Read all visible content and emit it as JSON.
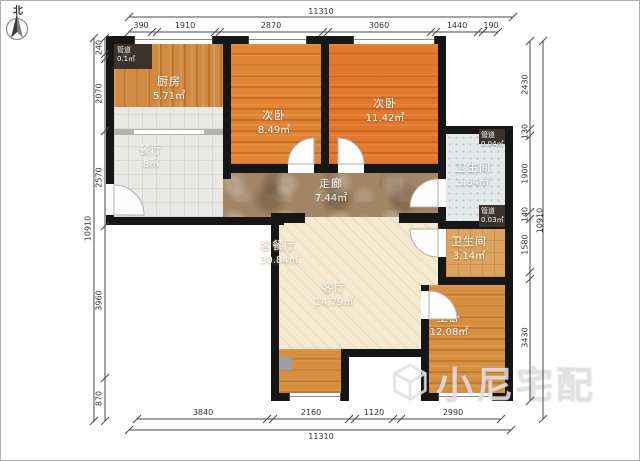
{
  "north_label": "北",
  "watermark": "小尼宅配",
  "dimensions": {
    "top": {
      "total": "11310",
      "segments": [
        "390",
        "1910",
        "2870",
        "3060",
        "1440",
        "190"
      ]
    },
    "bottom": {
      "total": "11310",
      "segments": [
        "3840",
        "2160",
        "1120",
        "2990"
      ]
    },
    "left": {
      "total": "10910",
      "segments": [
        "240",
        "2070",
        "2570",
        "3960",
        "870"
      ]
    },
    "right": {
      "total": "10910",
      "segments": [
        "2430",
        "130",
        "1900",
        "140",
        "1580",
        "3430"
      ]
    }
  },
  "rooms": {
    "kitchen": {
      "label": "厨房",
      "area": "5.71㎡"
    },
    "bedroom_a": {
      "label": "次卧",
      "area": "8.49㎡"
    },
    "bedroom_b": {
      "label": "次卧",
      "area": "11.42㎡"
    },
    "dining": {
      "label": "餐厅",
      "area": "8㎡"
    },
    "corridor": {
      "label": "走廊",
      "area": "7.44㎡"
    },
    "bath_a": {
      "label": "卫生间",
      "area": "3.84㎡"
    },
    "bath_b": {
      "label": "卫生间",
      "area": "3.14㎡"
    },
    "living_dining": {
      "label": "客餐厅",
      "area": "30.84㎡"
    },
    "living": {
      "label": "客厅",
      "area": "14.79㎡"
    },
    "master": {
      "label": "主卧",
      "area": "12.08㎡"
    },
    "duct_kitchen": {
      "label": "管道",
      "area": "0.1㎡"
    },
    "duct_a": {
      "label": "管道",
      "area": "0.04㎡"
    },
    "duct_b": {
      "label": "管道",
      "area": "0.03㎡"
    }
  },
  "colors": {
    "wall": "#161616",
    "wood_orange": "#d9832f",
    "marble_corridor": "#a18565",
    "tile_gray": "#e9e9e7",
    "bath_tile": "#e4e8e9",
    "living_cream": "#f4ead0",
    "dim_text": "#333333"
  }
}
